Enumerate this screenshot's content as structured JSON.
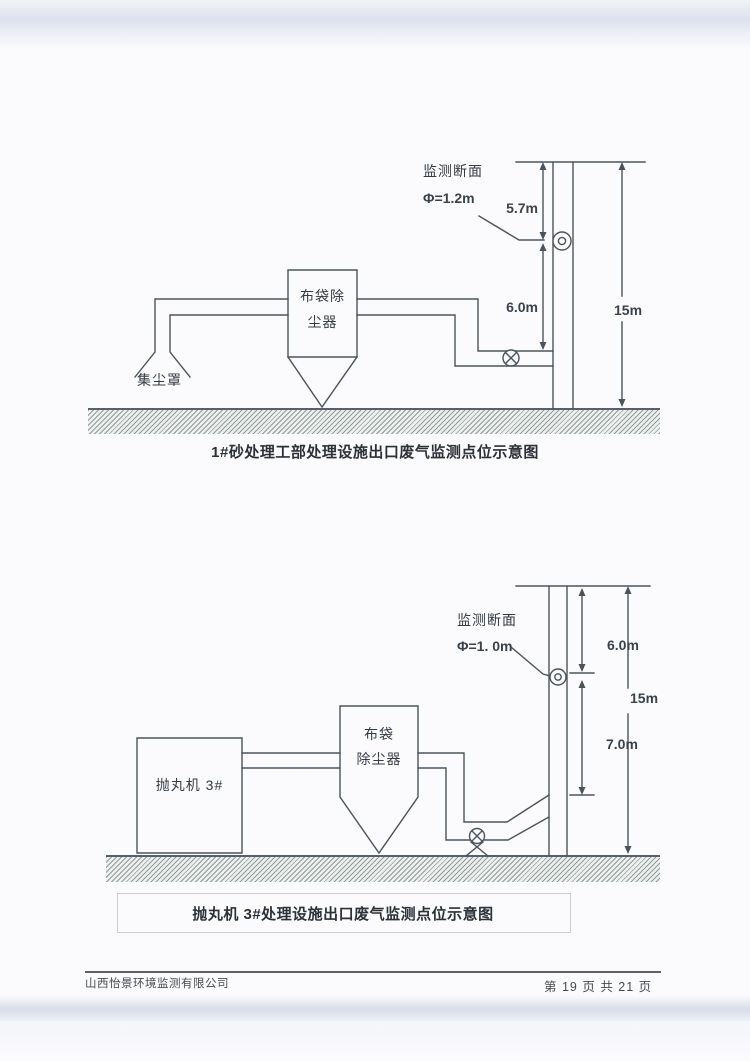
{
  "diagram1": {
    "caption": "1#砂处理工部处理设施出口废气监测点位示意图",
    "monitor_label": "监测断面",
    "monitor_diameter": "Φ=1.2m",
    "dim_top": "5.7m",
    "dim_mid": "6.0m",
    "dim_total": "15m",
    "collector_line1": "布袋除",
    "collector_line2": "尘器",
    "hood_label": "集尘罩"
  },
  "diagram2": {
    "caption": "抛丸机 3#处理设施出口废气监测点位示意图",
    "monitor_label": "监测断面",
    "monitor_diameter": "Φ=1. 0m",
    "dim_top": "6.0m",
    "dim_mid": "7.0m",
    "dim_total": "15m",
    "machine_label": "抛丸机 3#",
    "collector_line1": "布袋",
    "collector_line2": "除尘器"
  },
  "footer": {
    "company": "山西怡景环境监测有限公司",
    "page_info": "第 19 页 共 21 页"
  },
  "colors": {
    "line": "#4a545e",
    "text": "#343b44",
    "ground_hatch": "#546360",
    "paper": "#fbfbfd",
    "scan_edge_band": "#dde1ee",
    "caption_box_border": "#c7ccd6"
  }
}
